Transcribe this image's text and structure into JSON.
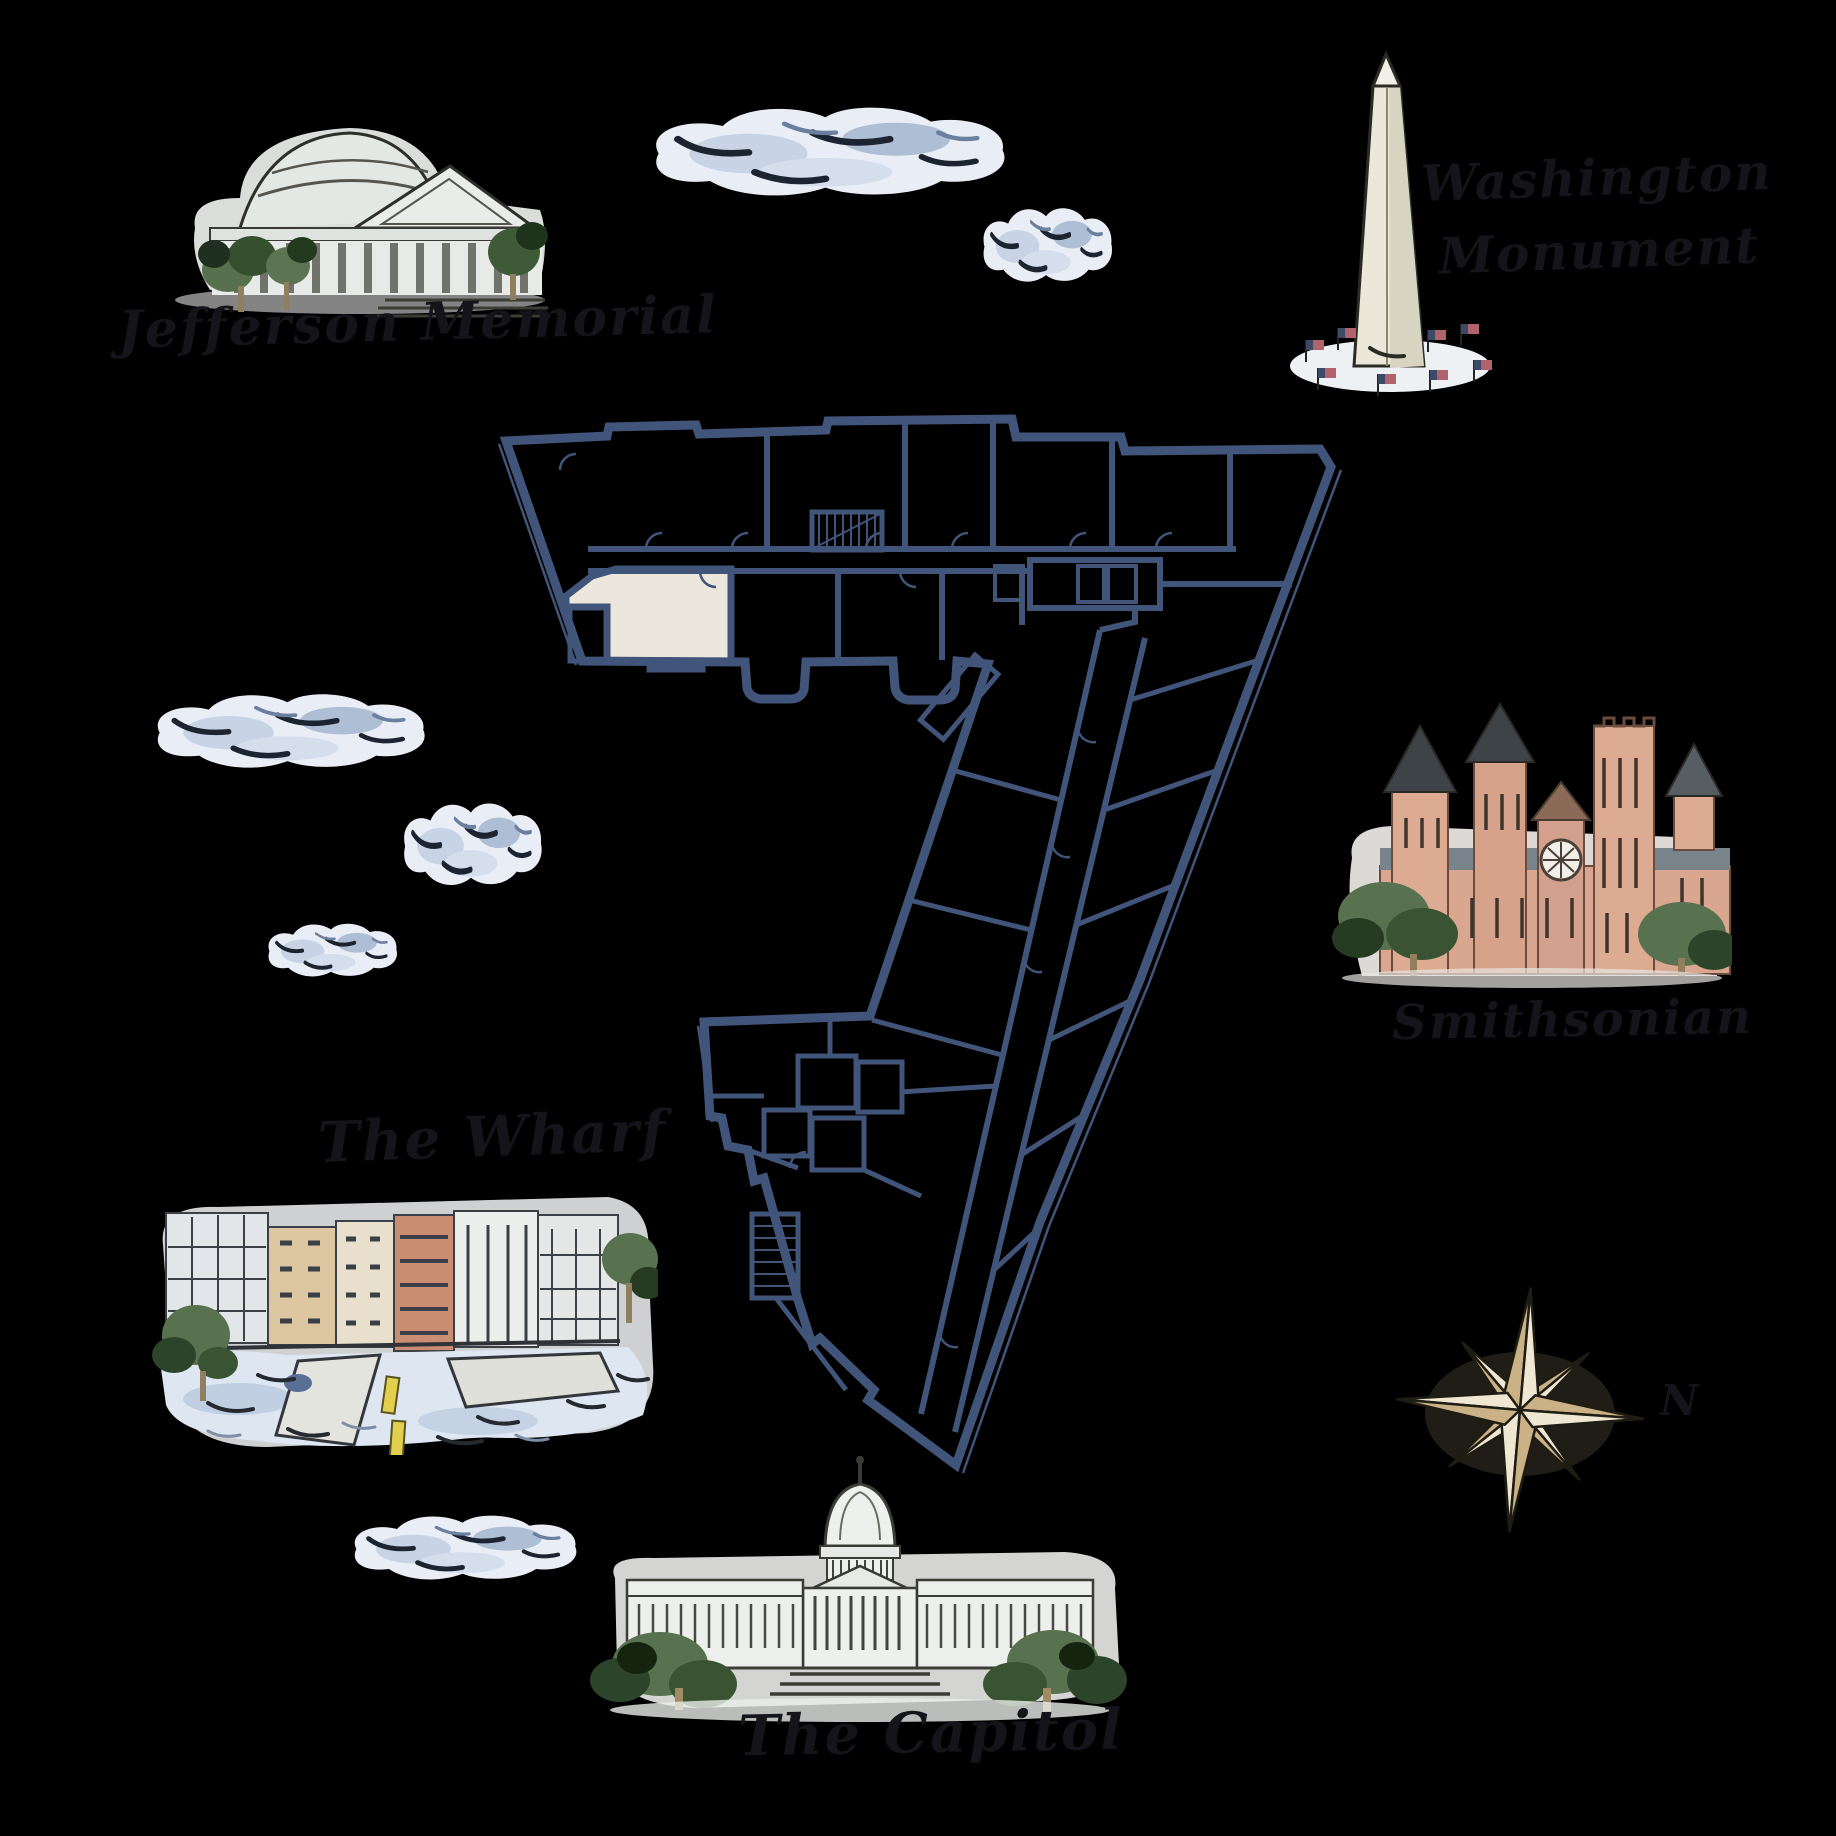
{
  "canvas": {
    "width": 1836,
    "height": 1836,
    "background": "#000000"
  },
  "map": {
    "title": "Washington DC illustrated landmarks map with building floor plan",
    "labels": {
      "jefferson_memorial": "Jefferson Memorial",
      "washington_monument_line1": "Washington",
      "washington_monument_line2": "Monument",
      "smithsonian": "Smithsonian",
      "the_wharf": "The Wharf",
      "the_capitol": "The Capitol",
      "compass_north": "N"
    },
    "illustrations": [
      "jefferson-memorial-illustration",
      "washington-monument-illustration",
      "smithsonian-castle-illustration",
      "the-wharf-illustration",
      "us-capitol-illustration",
      "compass-rose-icon",
      "watercolor-cloud-icon"
    ],
    "floor_plan": {
      "type": "architectural-floor-plan",
      "wall_color": "#41547a",
      "highlighted_unit_color": "#ece7dd"
    },
    "palette": {
      "background": "#000000",
      "ink": "#14141a",
      "floorplan_wall": "#41547a",
      "floorplan_highlight": "#ece7dd",
      "cloud_base": "#e9eef6",
      "cloud_shadow": "#9fb2cd",
      "cloud_stroke": "#1d2431",
      "stone_light": "#e9ece9",
      "monument_stone": "#ebe8da",
      "smithsonian_salmon": "#d9a68f",
      "roof_gray": "#79838b",
      "tree_green": "#58724f",
      "tree_dark": "#263b22",
      "water_blue": "#dde6f1",
      "compass_gold": "#cbb186",
      "flag_red": "#b2626a",
      "flag_blue": "#3c4a68",
      "kayak_yellow": "#e2cf4e"
    }
  }
}
